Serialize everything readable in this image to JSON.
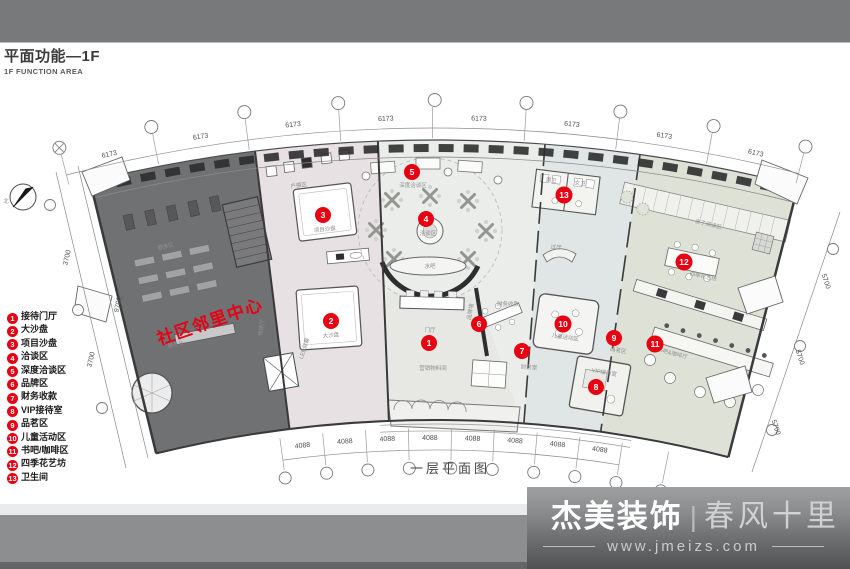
{
  "header": {
    "title": "平面功能—1F",
    "subtitle": "1F FUNCTION AREA"
  },
  "legend": {
    "items": [
      {
        "num": "1",
        "label": "接待门厅"
      },
      {
        "num": "2",
        "label": "大沙盘"
      },
      {
        "num": "3",
        "label": "项目沙盘"
      },
      {
        "num": "4",
        "label": "洽谈区"
      },
      {
        "num": "5",
        "label": "深度洽谈区"
      },
      {
        "num": "6",
        "label": "品牌区"
      },
      {
        "num": "7",
        "label": "财务收款"
      },
      {
        "num": "8",
        "label": "VIP接待室"
      },
      {
        "num": "9",
        "label": "品茗区"
      },
      {
        "num": "10",
        "label": "儿童活动区"
      },
      {
        "num": "11",
        "label": "书吧/咖啡区"
      },
      {
        "num": "12",
        "label": "四季花艺坊"
      },
      {
        "num": "13",
        "label": "卫生间"
      }
    ]
  },
  "plan": {
    "caption": "一层平面图",
    "north": "北",
    "community_text": "社区邻里中心",
    "markers": [
      "1",
      "2",
      "3",
      "4",
      "5",
      "6",
      "7",
      "8",
      "9",
      "10",
      "11",
      "12",
      "13"
    ],
    "dims": {
      "top": "6173",
      "bottom": "4088",
      "left": "3700",
      "left2": "9700",
      "right": "5700"
    },
    "rooms": {
      "fitness": "健身区",
      "service": "服务台",
      "elevator": "电梯厅",
      "model": "户模区",
      "led": "LED屏幕",
      "project_sand": "项目沙盘",
      "big_sand": "大沙盘",
      "deep": "深度洽谈区",
      "talk": "洽谈区",
      "bar": "水吧",
      "hall": "门厅",
      "brandwall": "品牌墙",
      "materials": "营销物料间",
      "cashier": "财务收款",
      "finance": "财务室",
      "kids": "儿童活动区",
      "vip": "VIP接待室",
      "lobby": "过厅",
      "male": "男卫",
      "female": "女卫",
      "tea": "品茗区",
      "flower": "四季花艺坊",
      "book": "书吧&咖啡厅",
      "reading": "亲子阅读区"
    },
    "colors": {
      "accent_red": "#e60012",
      "topbar": "#78797b",
      "zone_dark": "#707173",
      "zone_pink": "#e7e1e4",
      "zone_center": "#ebedea",
      "zone_blue": "#dfe6e5",
      "zone_sage": "#dee2d6",
      "wall": "#2e2e30"
    }
  },
  "footer": {
    "brand": "杰美装饰",
    "separator": "|",
    "slogan": "春风十里",
    "website": "www.jmeizs.com"
  }
}
